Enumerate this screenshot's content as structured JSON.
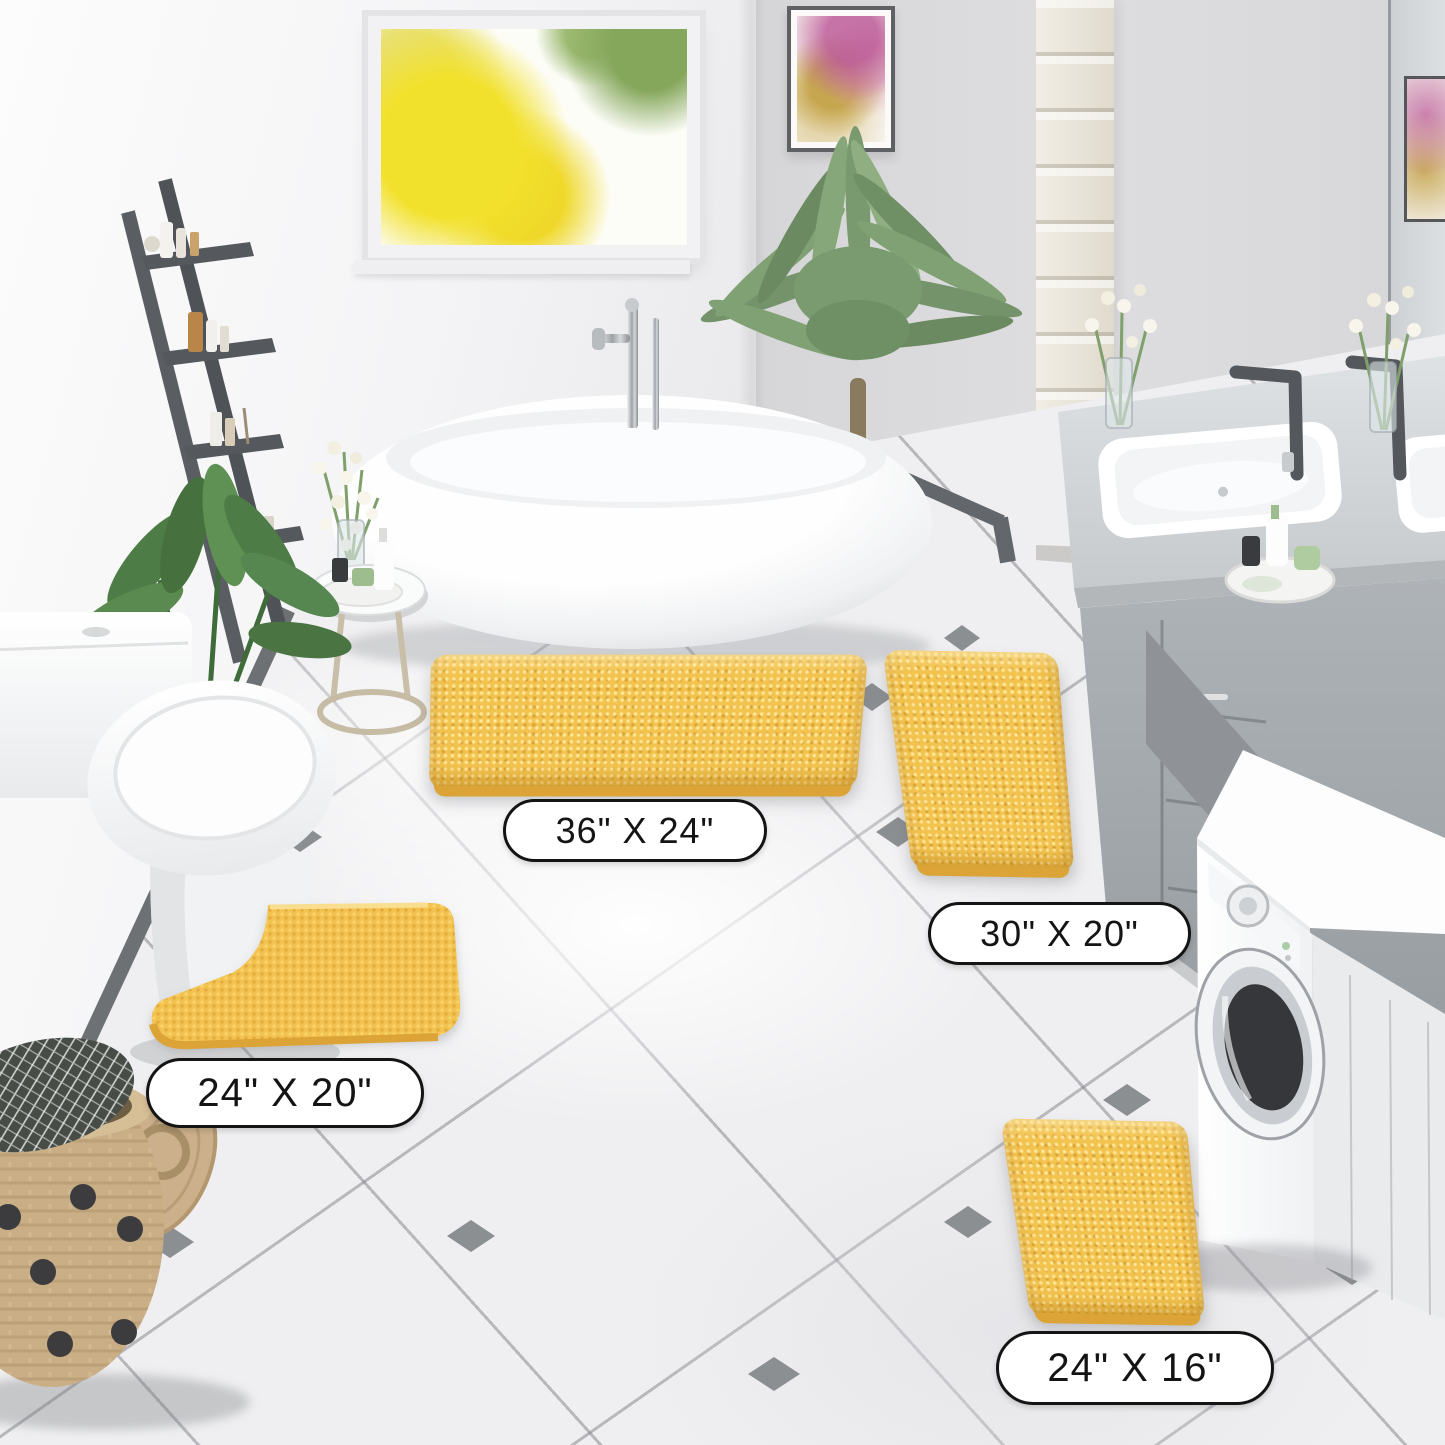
{
  "image": {
    "kind": "product-lifestyle-photo",
    "subject": "4-piece yellow chenille bathroom rug set shown in a modern gray-and-white bathroom"
  },
  "rugs": {
    "large": {
      "label": "36\" X 24\""
    },
    "runner": {
      "label": "30\" X 20\""
    },
    "contour": {
      "label": "24\" X 20\""
    },
    "small": {
      "label": "24\" X 16\""
    }
  },
  "colors": {
    "rug": "#F3C350",
    "rug_highlight": "#F8D26B",
    "rug_shadow": "#DCA437",
    "floor_tile": "#EFEFF1",
    "grout": "#8A8B90",
    "tile_diamond": "#8C8F92",
    "wall_left": "#F4F4F6",
    "wall_right": "#DADADC",
    "vanity_gray": "#A3A8AC",
    "label_bg": "#FFFFFF",
    "label_border": "#141414"
  },
  "objects": [
    "window",
    "wall-art",
    "ladder-shelf",
    "freestanding-bathtub",
    "tub-faucet",
    "palm-plant",
    "side-table",
    "flower-vase",
    "toilet",
    "potted-plant",
    "laundry-basket",
    "tall-cabinet",
    "vanity",
    "vanity-sink",
    "vanity-faucet",
    "washing-machine",
    "mirror",
    "tile-floor"
  ]
}
